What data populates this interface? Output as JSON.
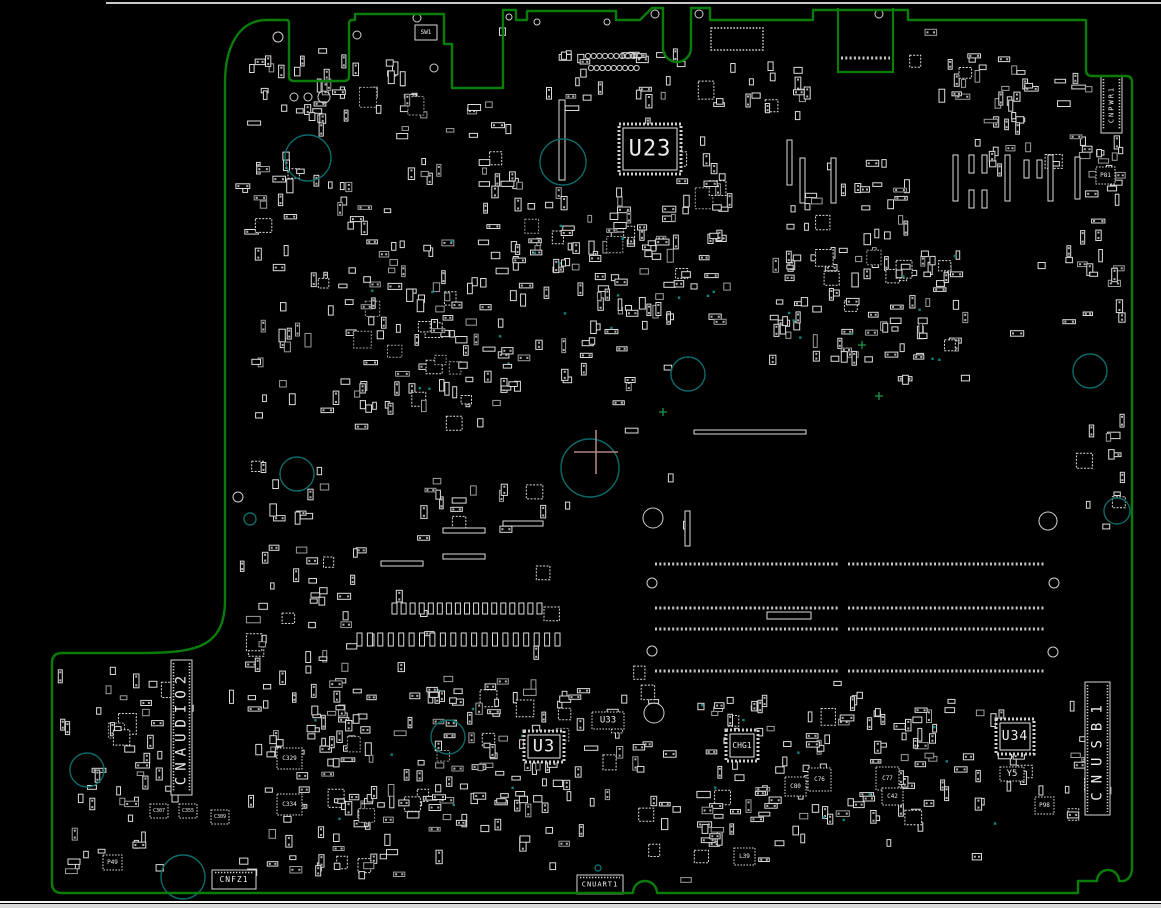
{
  "drawing": {
    "title": "pcb-assembly-bottom-view",
    "colors": {
      "background": "#000000",
      "outline": "#0a7c0a",
      "component": "#dcdcdc",
      "component_dim": "#9d9d9d",
      "hole_teal": "#0e6a6a",
      "hole_white": "#cfcfcf",
      "origin_cross": "#b08484",
      "fiducial": "#1f9e4f",
      "top_line": "#c9c9c9",
      "bottom_line": "#f5f5f5",
      "bottom_strip": "#dadada",
      "via_dot": "#0f8484"
    },
    "board_outline_path": "M267,20 H287 Q289,20 289,24 V76 Q289,81 294,81 H344 Q349,81 349,76 V24 Q349,20 352,20 H355 V14 H444 V44 H452 V88 H503 V10 H516 V20 H527 V11 H616 V20 H640 L652,8 H663 V48 A14 14 0 0 0 691,48 V8 H710 V20 H813 V10 H908 V20 H1086 V70 Q1086,76 1092,76 H1126 Q1132,76 1132,82 V868 Q1132,878 1124,881 H1119 A11 11 0 0 0 1097,881 H1078 L1078,893 H657 A12 12 0 0 0 633,893 H62 Q52,893 52,883 V663 Q52,653 62,653 H140 C195,653 225,648 225,600 V83 C225,48 238,20 267,20 Z",
    "edge_slot_path": "M838,8 V72 H893 V8",
    "edge_pad_row": {
      "y": 58,
      "x0": 841,
      "x1": 890
    },
    "dotted_connector": {
      "x": 711,
      "y": 28,
      "w": 52,
      "h": 22
    },
    "top_line": {
      "x0": 106,
      "x1": 1161,
      "y": 3
    },
    "bottom_strip": {
      "line_y": 901,
      "strip_y": 904,
      "strip_h": 4
    },
    "origin_cross": {
      "x": 596,
      "y": 452,
      "arm": 22
    },
    "fiducials": [
      [
        862,
        345
      ],
      [
        879,
        396
      ],
      [
        663,
        412
      ]
    ],
    "labeled_components": [
      {
        "id": "U23",
        "x": 619,
        "y": 124,
        "w": 62,
        "h": 50,
        "b": "hatch",
        "fs": 22,
        "ls": 1
      },
      {
        "id": "U3",
        "x": 524,
        "y": 731,
        "w": 40,
        "h": 31,
        "b": "hatch",
        "fs": 17,
        "ls": 1
      },
      {
        "id": "U33",
        "x": 592,
        "y": 712,
        "w": 32,
        "h": 17,
        "b": "dot",
        "fs": 9,
        "ls": 0
      },
      {
        "id": "U34",
        "x": 996,
        "y": 719,
        "w": 38,
        "h": 35,
        "b": "hatch",
        "fs": 13,
        "ls": 1
      },
      {
        "id": "Y5",
        "x": 1000,
        "y": 767,
        "w": 24,
        "h": 14,
        "b": "dot",
        "fs": 9,
        "ls": 0
      },
      {
        "id": "CHG1",
        "x": 726,
        "y": 730,
        "w": 32,
        "h": 31,
        "b": "hatch",
        "fs": 8,
        "ls": 0
      },
      {
        "id": "SW1",
        "x": 415,
        "y": 25,
        "w": 22,
        "h": 15,
        "b": "solid",
        "fs": 6,
        "ls": 0
      },
      {
        "id": "P81",
        "x": 1096,
        "y": 167,
        "w": 19,
        "h": 17,
        "b": "dot",
        "fs": 6,
        "ls": 0
      },
      {
        "id": "P98",
        "x": 1035,
        "y": 797,
        "w": 19,
        "h": 17,
        "b": "dot",
        "fs": 6,
        "ls": 0
      },
      {
        "id": "P49",
        "x": 103,
        "y": 855,
        "w": 19,
        "h": 15,
        "b": "dot",
        "fs": 6,
        "ls": 0
      },
      {
        "id": "C329",
        "x": 277,
        "y": 748,
        "w": 25,
        "h": 21,
        "b": "dot",
        "fs": 6,
        "ls": 0
      },
      {
        "id": "C334",
        "x": 277,
        "y": 794,
        "w": 25,
        "h": 21,
        "b": "dot",
        "fs": 6,
        "ls": 0
      },
      {
        "id": "C307",
        "x": 150,
        "y": 804,
        "w": 18,
        "h": 14,
        "b": "dot",
        "fs": 5,
        "ls": 0
      },
      {
        "id": "C355",
        "x": 179,
        "y": 804,
        "w": 18,
        "h": 14,
        "b": "dot",
        "fs": 5,
        "ls": 0
      },
      {
        "id": "C309",
        "x": 211,
        "y": 810,
        "w": 18,
        "h": 14,
        "b": "dot",
        "fs": 5,
        "ls": 0
      },
      {
        "id": "C76",
        "x": 808,
        "y": 768,
        "w": 23,
        "h": 23,
        "b": "dot",
        "fs": 6,
        "ls": 0
      },
      {
        "id": "C77",
        "x": 876,
        "y": 767,
        "w": 23,
        "h": 23,
        "b": "dot",
        "fs": 6,
        "ls": 0
      },
      {
        "id": "C80",
        "x": 785,
        "y": 777,
        "w": 21,
        "h": 19,
        "b": "dot",
        "fs": 6,
        "ls": 0
      },
      {
        "id": "C42",
        "x": 882,
        "y": 788,
        "w": 21,
        "h": 17,
        "b": "dot",
        "fs": 6,
        "ls": 0
      },
      {
        "id": "L39",
        "x": 734,
        "y": 848,
        "w": 21,
        "h": 17,
        "b": "dot",
        "fs": 6,
        "ls": 0
      },
      {
        "id": "CNAUDIO2",
        "x": 171,
        "y": 660,
        "w": 21,
        "h": 135,
        "b": "conn-v",
        "rot": -90,
        "fs": 14,
        "ls": 6
      },
      {
        "id": "CNUSB1",
        "x": 1085,
        "y": 682,
        "w": 25,
        "h": 133,
        "b": "conn-v",
        "rot": -90,
        "fs": 14,
        "ls": 9
      },
      {
        "id": "CNPWR1",
        "x": 1101,
        "y": 76,
        "w": 21,
        "h": 57,
        "b": "conn-v",
        "rot": -90,
        "fs": 7,
        "ls": 2
      },
      {
        "id": "CNFZ1",
        "x": 212,
        "y": 870,
        "w": 44,
        "h": 19,
        "b": "conn-h",
        "fs": 8,
        "ls": 1
      },
      {
        "id": "CNUART1",
        "x": 577,
        "y": 875,
        "w": 46,
        "h": 19,
        "b": "conn-h",
        "fs": 7,
        "ls": 1
      }
    ],
    "holes_teal": [
      [
        308,
        158,
        23
      ],
      [
        563,
        162,
        23
      ],
      [
        590,
        468,
        29
      ],
      [
        688,
        374,
        17
      ],
      [
        297,
        474,
        17
      ],
      [
        1090,
        371,
        17
      ],
      [
        1117,
        511,
        13
      ],
      [
        250,
        519,
        6
      ],
      [
        87,
        770,
        17
      ],
      [
        448,
        737,
        17
      ],
      [
        183,
        877,
        22
      ],
      [
        598,
        868,
        3
      ]
    ],
    "holes_white": [
      [
        653,
        518,
        10
      ],
      [
        658,
        523,
        0
      ],
      [
        654,
        713,
        10
      ],
      [
        1048,
        521,
        9
      ],
      [
        652,
        583,
        5
      ],
      [
        1054,
        583,
        5
      ],
      [
        652,
        651,
        5
      ],
      [
        1053,
        652,
        5
      ],
      [
        294,
        97,
        4
      ],
      [
        308,
        97,
        4
      ],
      [
        324,
        97,
        6
      ],
      [
        278,
        37,
        5
      ],
      [
        357,
        35,
        4
      ],
      [
        417,
        18,
        4
      ],
      [
        509,
        17,
        3
      ],
      [
        537,
        22,
        3
      ],
      [
        607,
        22,
        3
      ],
      [
        655,
        14,
        4
      ],
      [
        699,
        14,
        4
      ],
      [
        879,
        14,
        4
      ],
      [
        434,
        68,
        4
      ],
      [
        238,
        497,
        5
      ]
    ],
    "top_circle_rows": [
      {
        "y": 56,
        "x0": 588,
        "n": 10,
        "dx": 5.7,
        "r": 2.6
      },
      {
        "y": 68,
        "x0": 591,
        "n": 9,
        "dx": 5.7,
        "r": 2.6
      }
    ],
    "dimm": {
      "rows": [
        564,
        608,
        629,
        671
      ],
      "segments": [
        [
          655,
          838
        ],
        [
          848,
          1045
        ]
      ]
    },
    "pad_rows": [
      {
        "y": 603,
        "x0": 392,
        "x1": 537,
        "n": 17,
        "w": 5,
        "h": 11
      },
      {
        "y": 633,
        "x0": 357,
        "x1": 555,
        "n": 20,
        "w": 5,
        "h": 13
      }
    ],
    "thin_rects": [
      [
        503,
        521,
        40,
        5
      ],
      [
        443,
        528,
        42,
        5
      ],
      [
        443,
        554,
        42,
        5
      ],
      [
        381,
        561,
        42,
        5
      ],
      [
        767,
        612,
        44,
        7
      ],
      [
        694,
        430,
        112,
        4
      ],
      [
        685,
        511,
        5,
        35
      ],
      [
        559,
        100,
        6,
        80
      ],
      [
        787,
        140,
        5,
        45
      ],
      [
        800,
        158,
        5,
        45
      ],
      [
        831,
        158,
        5,
        45
      ],
      [
        953,
        155,
        5,
        46
      ],
      [
        1005,
        155,
        5,
        46
      ],
      [
        1048,
        155,
        5,
        46
      ],
      [
        1075,
        157,
        5,
        42
      ],
      [
        969,
        155,
        5,
        18
      ],
      [
        982,
        155,
        5,
        18
      ],
      [
        969,
        190,
        5,
        18
      ],
      [
        982,
        190,
        5,
        18
      ],
      [
        1024,
        160,
        5,
        18
      ],
      [
        1037,
        160,
        5,
        18
      ]
    ],
    "clusters": [
      [
        250,
        60,
        170,
        60,
        38
      ],
      [
        240,
        150,
        130,
        90,
        25
      ],
      [
        250,
        250,
        110,
        170,
        26
      ],
      [
        360,
        240,
        180,
        150,
        85
      ],
      [
        350,
        390,
        170,
        40,
        14
      ],
      [
        545,
        55,
        150,
        60,
        22
      ],
      [
        555,
        180,
        90,
        230,
        40
      ],
      [
        610,
        215,
        120,
        110,
        45
      ],
      [
        700,
        60,
        110,
        60,
        16
      ],
      [
        770,
        250,
        200,
        110,
        85
      ],
      [
        790,
        180,
        120,
        60,
        18
      ],
      [
        930,
        55,
        150,
        70,
        30
      ],
      [
        940,
        120,
        200,
        50,
        18
      ],
      [
        1080,
        120,
        50,
        120,
        16
      ],
      [
        240,
        540,
        130,
        110,
        26
      ],
      [
        250,
        650,
        130,
        120,
        30
      ],
      [
        300,
        680,
        230,
        160,
        75
      ],
      [
        240,
        790,
        160,
        90,
        30
      ],
      [
        430,
        680,
        140,
        120,
        35
      ],
      [
        490,
        760,
        120,
        90,
        20
      ],
      [
        560,
        690,
        110,
        80,
        18
      ],
      [
        60,
        660,
        110,
        100,
        20
      ],
      [
        60,
        770,
        120,
        110,
        22
      ],
      [
        700,
        700,
        200,
        150,
        70
      ],
      [
        900,
        700,
        130,
        130,
        40
      ],
      [
        1040,
        700,
        60,
        120,
        14
      ],
      [
        640,
        780,
        80,
        80,
        14
      ],
      [
        1080,
        420,
        50,
        110,
        14
      ],
      [
        1060,
        250,
        70,
        90,
        12
      ],
      [
        430,
        480,
        120,
        50,
        12
      ],
      [
        250,
        460,
        80,
        60,
        10
      ],
      [
        380,
        100,
        120,
        80,
        20
      ],
      [
        480,
        160,
        80,
        80,
        14
      ],
      [
        660,
        140,
        80,
        80,
        16
      ]
    ],
    "scatter": {
      "count": 140,
      "seed": 1337
    }
  }
}
